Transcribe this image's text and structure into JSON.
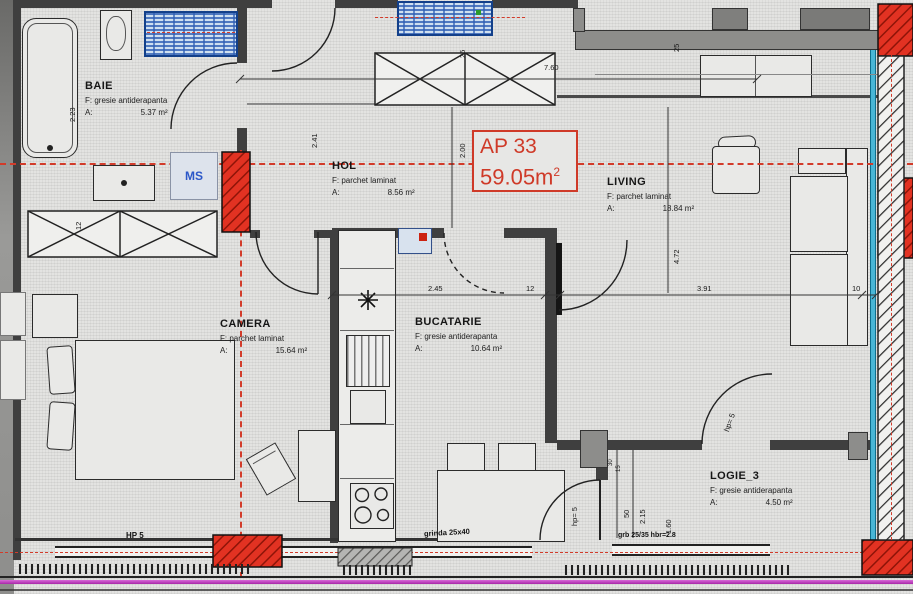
{
  "plan": {
    "title": {
      "apartment": "AP 33",
      "area_value": "59.05m",
      "area_sup": "2"
    },
    "rooms": [
      {
        "name": "BAIE",
        "finish_prefix": "F:",
        "finish": "gresie antiderapanta",
        "area_prefix": "A:",
        "area": "5.37 m²"
      },
      {
        "name": "HOL",
        "finish_prefix": "F:",
        "finish": "parchet laminat",
        "area_prefix": "A:",
        "area": "8.56 m²"
      },
      {
        "name": "LIVING",
        "finish_prefix": "F:",
        "finish": "parchet laminat",
        "area_prefix": "A:",
        "area": "18.84 m²"
      },
      {
        "name": "CAMERA",
        "finish_prefix": "F:",
        "finish": "parchet laminat",
        "area_prefix": "A:",
        "area": "15.64 m²"
      },
      {
        "name": "BUCATARIE",
        "finish_prefix": "F:",
        "finish": "gresie antiderapanta",
        "area_prefix": "A:",
        "area": "10.64 m²"
      },
      {
        "name": "LOGIE_3",
        "finish_prefix": "F:",
        "finish": "gresie antiderapanta",
        "area_prefix": "A:",
        "area": "4.50 m²"
      }
    ],
    "annotations": {
      "ms": "MS",
      "hp5_window": "HP 5",
      "hp5_kitchen_door": "hp= 5",
      "hp5_living_door": "hp= 5",
      "beam_kitchen": "grinda 25x40",
      "beam_loggia": "grb 25/35 hbr=2.8"
    },
    "dimensions": {
      "top_width": "7.60",
      "hall_width": "2.00",
      "wall_25_top": "25",
      "wall_25_living": "25",
      "hall_height": "2.41",
      "bath_height": "2.23",
      "wardrobe_depth": "12",
      "kitchen_width": "2.45",
      "wall_12": "12",
      "living_width": "3.91",
      "wall_10": "10",
      "living_height": "4.72",
      "loggia_30": "30",
      "loggia_15": "15",
      "loggia_50": "50",
      "loggia_height": "2.15",
      "loggia_160": "1.60"
    },
    "colors": {
      "axis_red": "#d23b2a",
      "column_red": "#e23222",
      "magenta": "#bf3fbf",
      "window_cyan": "#49b6d6",
      "fixture_blue": "#2f5fb5",
      "label_blue": "#2b57c8"
    }
  }
}
